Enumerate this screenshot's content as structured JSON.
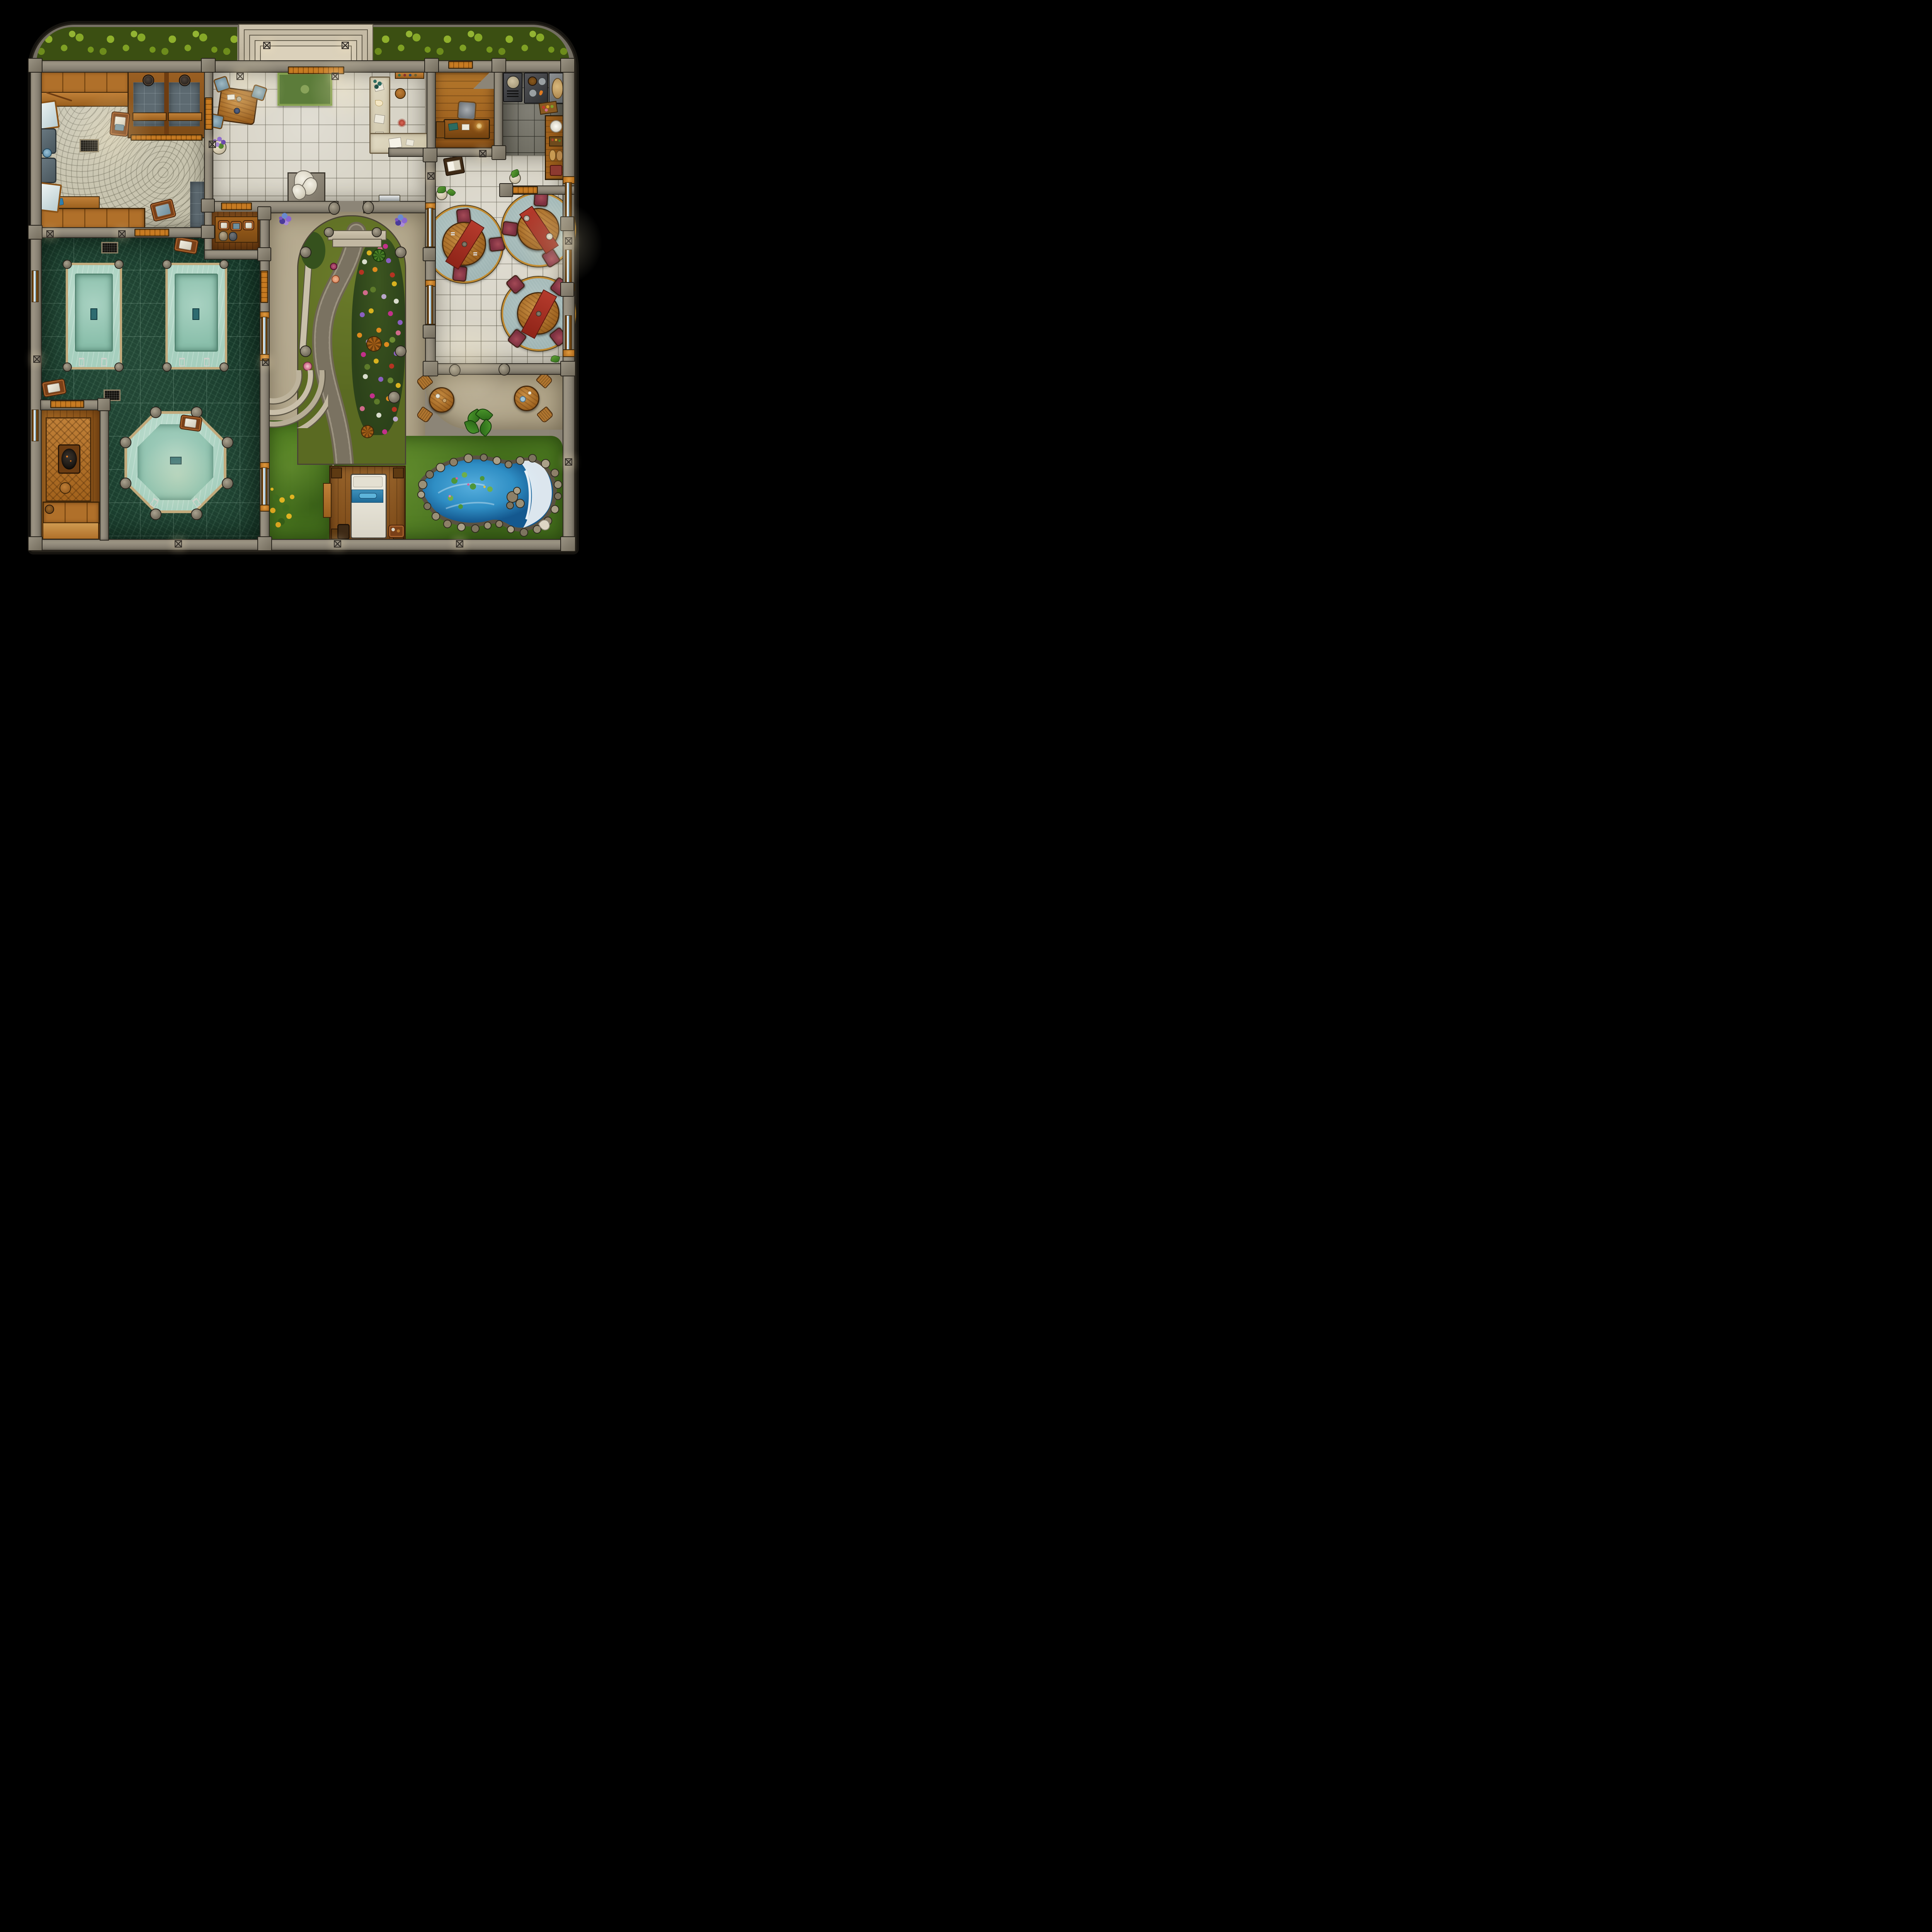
{
  "map": {
    "title": "Bathhouse and garden courtyard - top-down fantasy battle map",
    "type": "top-down-floorplan",
    "palette": {
      "wall": "#8c8577",
      "wall-light": "#a79f8d",
      "door": "#c87b22",
      "cobble": "#c8c4af",
      "tile": "#d8d4c7",
      "kitchen-tile": "#6f6d62",
      "slate": "#5d6a71",
      "marble": "#17392a",
      "water": "#a6cfbe",
      "water-deep": "#8abfab",
      "rim": "#c2aa7c",
      "wood": "#b0702a",
      "grass": "#4e7c20",
      "moss": "#5a6a22",
      "patio": "#b2a68a",
      "pond": "#2f8ec4",
      "pond-deep": "#14588f",
      "roofgrass": "#3b4f12",
      "rug-green": "#5c7c3a",
      "rug-blue": "#9fb5b4",
      "rug-trim": "#c28a2e",
      "chair-red": "#7c3040"
    },
    "rooms": [
      {
        "id": "changing-room",
        "label": "Changing room"
      },
      {
        "id": "changing-stalls",
        "label": "Changing stalls"
      },
      {
        "id": "entrance-hall",
        "label": "Entrance hall"
      },
      {
        "id": "reception",
        "label": "Reception counter"
      },
      {
        "id": "office",
        "label": "Office"
      },
      {
        "id": "kitchen",
        "label": "Kitchen"
      },
      {
        "id": "dining-hall",
        "label": "Dining hall"
      },
      {
        "id": "towel-store",
        "label": "Towel store"
      },
      {
        "id": "pool-hall",
        "label": "Bathing pool hall"
      },
      {
        "id": "sauna",
        "label": "Sauna"
      },
      {
        "id": "courtyard-garden",
        "label": "Courtyard garden"
      },
      {
        "id": "terrace",
        "label": "Terrace"
      },
      {
        "id": "massage-deck",
        "label": "Massage deck"
      },
      {
        "id": "pond",
        "label": "Waterfall pond"
      }
    ],
    "features": {
      "rectangular_pools": 2,
      "octagonal_pool": 1,
      "dining_tables": 3,
      "terrace_tables": 2,
      "entrance_step_tiers": 4,
      "massage_beds": 1,
      "changing_stalls": 2,
      "wall_lanterns": 14
    }
  }
}
